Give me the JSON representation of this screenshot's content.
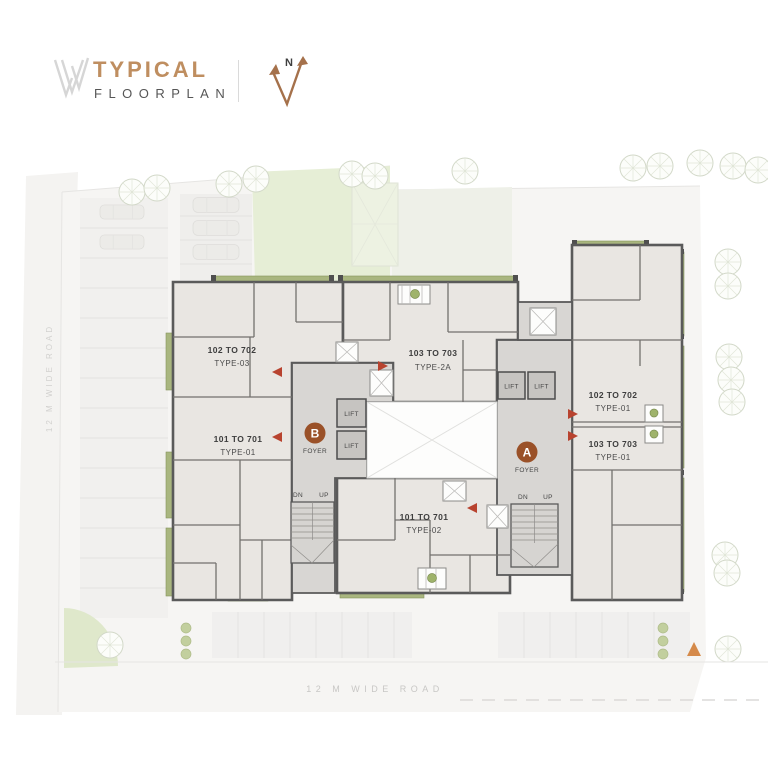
{
  "header": {
    "title_top": "TYPICAL",
    "title_bottom": "FLOORPLAN",
    "north_label": "N"
  },
  "roads": {
    "left": "12 M WIDE ROAD",
    "bottom": "12 M WIDE ROAD"
  },
  "units": [
    {
      "range": "102 TO 702",
      "type": "TYPE-03"
    },
    {
      "range": "101 TO 701",
      "type": "TYPE-01"
    },
    {
      "range": "103 TO 703",
      "type": "TYPE-2A"
    },
    {
      "range": "101 TO 701",
      "type": "TYPE-02"
    },
    {
      "range": "102 TO 702",
      "type": "TYPE-01"
    },
    {
      "range": "103 TO 703",
      "type": "TYPE-01"
    }
  ],
  "cores": {
    "foyer_a": {
      "badge": "A",
      "label": "FOYER"
    },
    "foyer_b": {
      "badge": "B",
      "label": "FOYER"
    },
    "lift_label": "LIFT",
    "stairs": {
      "down": "DN",
      "up": "UP"
    }
  },
  "icons": {
    "north_arrow": "north-compass-arrow",
    "tree": "tree-canopy-icon",
    "entry_arrow": "unit-entry-arrow"
  },
  "colors": {
    "accent_bronze": "#bf8e60",
    "badge_brown": "#9a5128",
    "balcony_green": "#a9b67f",
    "wall_gray": "#5a5a5a",
    "room_fill": "#e9e6e2",
    "core_fill": "#d8d6d3",
    "lawn_green": "#e6eed6",
    "road_text": "#c8c7c5",
    "arrow_red": "#b8432f"
  }
}
